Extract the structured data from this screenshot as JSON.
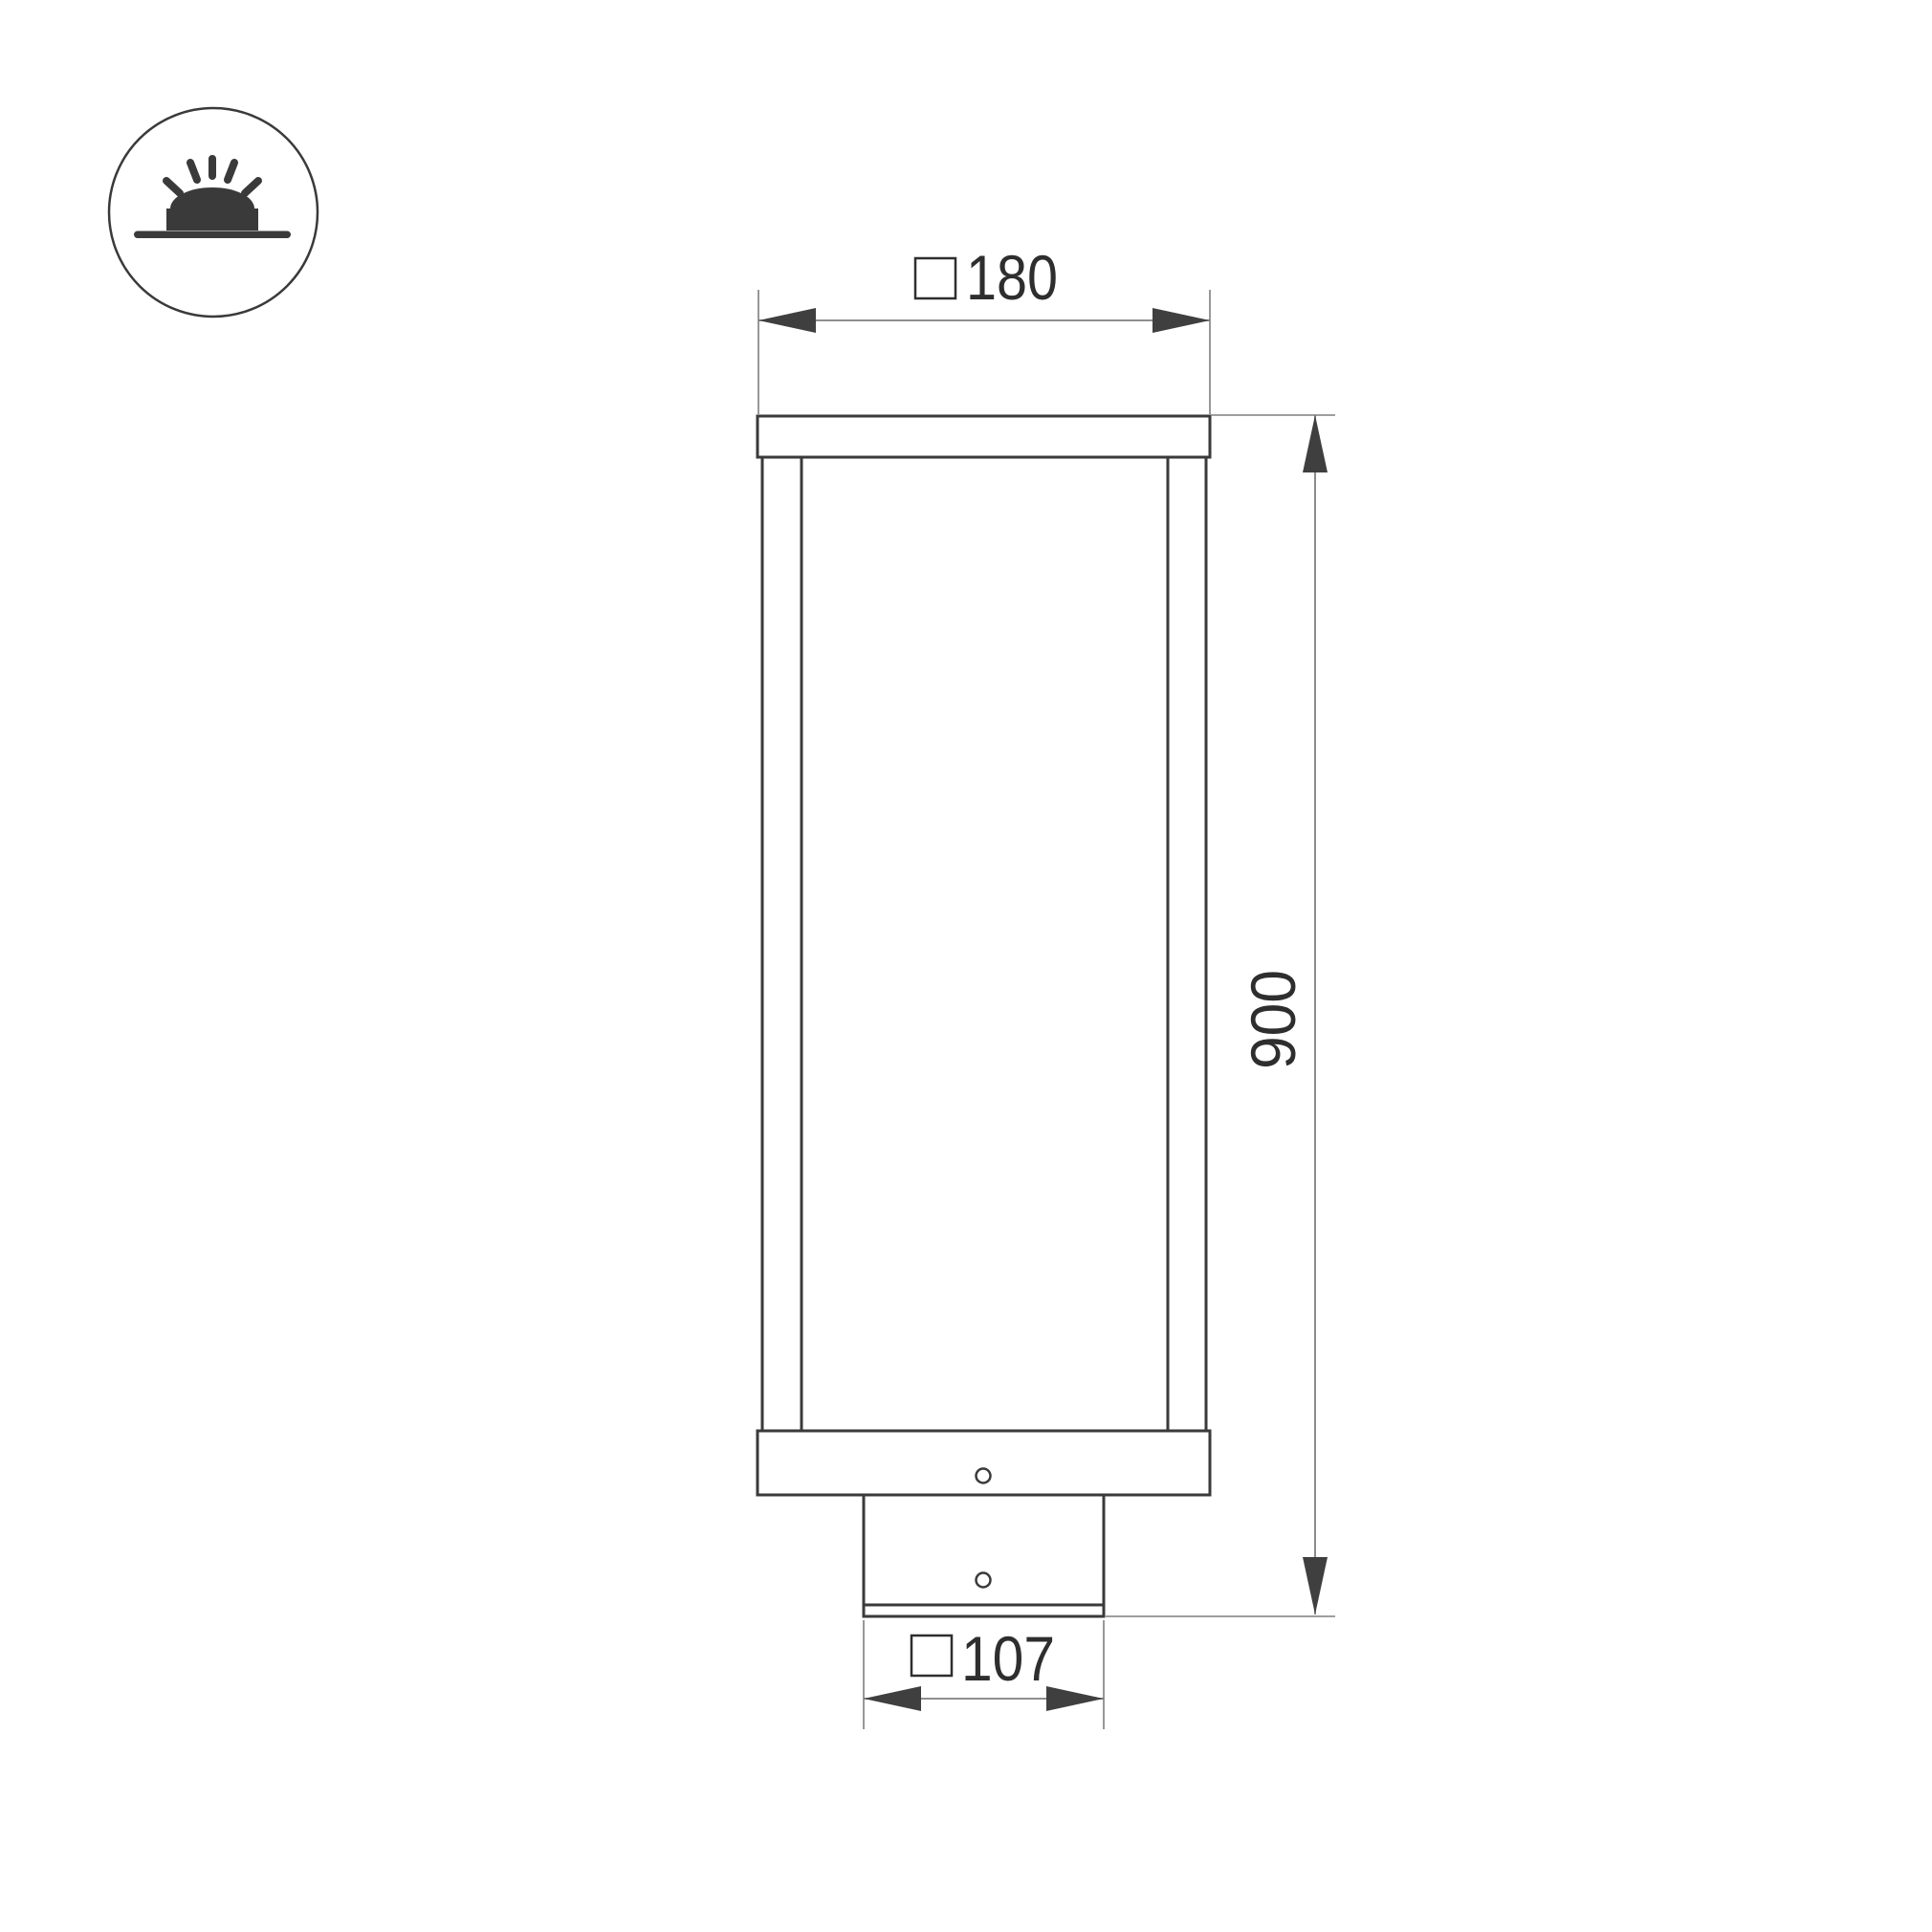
{
  "colors": {
    "outline": "#3a3a3a",
    "dimension": "#7f7f7f",
    "arrow": "#3f3f3f",
    "text": "#2e2e2e",
    "background": "#ffffff"
  },
  "icon": {
    "name": "surface-mounted-luminaire-icon",
    "description": "circle badge with glowing dome light on ground line"
  },
  "drawing": {
    "subject": "bollard light front elevation",
    "dimensions": {
      "top_width": {
        "symbol": "□",
        "value": "180",
        "label": "□180"
      },
      "height": {
        "value": "900",
        "label": "900"
      },
      "base_width": {
        "symbol": "□",
        "value": "107",
        "label": "□107"
      }
    }
  }
}
